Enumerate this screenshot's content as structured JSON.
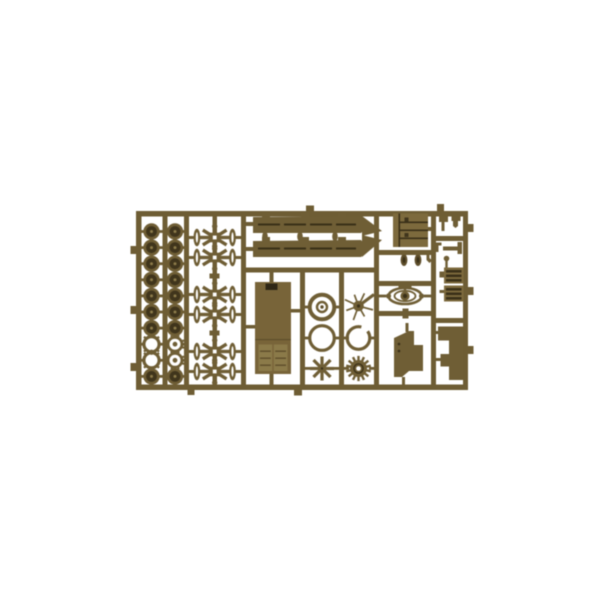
{
  "image": {
    "kind": "product photo",
    "description": "Olive-drab injection-molded plastic sprue (parts tree) of a small-scale tank model kit photographed on a plain white background",
    "background": "#ffffff"
  },
  "colors": {
    "rail": "#6e5d34",
    "plastic": "#6f5e35",
    "deck": "#7d6a3d",
    "super": "#786439",
    "pdark": "#40351c",
    "pdeep": "#3a3018",
    "pdeep2": "#2f2716",
    "pmid": "#5e4e2b",
    "plight": "#8b7a49"
  },
  "sprue": {
    "wheel_columns": [
      {
        "pattern": [
          "solid",
          "solid",
          "solid",
          "solid",
          "solid",
          "solid",
          "solid",
          "open",
          "open",
          "solid"
        ]
      },
      {
        "pattern": [
          "solid",
          "solid",
          "solid",
          "solid",
          "solid",
          "solid",
          "solid",
          "toothed",
          "toothed",
          "solid"
        ]
      }
    ],
    "bogie_count": 6,
    "star_wheel_spokes": 8,
    "sprocket_teeth": 14,
    "spider_legs": 7,
    "inventory": [
      {
        "part": "road wheel (solid)",
        "count": 16
      },
      {
        "part": "road wheel (open ring)",
        "count": 2
      },
      {
        "part": "road wheel (toothed ring)",
        "count": 2
      },
      {
        "part": "suspension bogie assembly",
        "count": 6
      },
      {
        "part": "track fender / hull side",
        "count": 2
      },
      {
        "part": "fender end tip",
        "count": 2
      },
      {
        "part": "connector pill",
        "count": 3
      },
      {
        "part": "engine deck plate",
        "count": 1
      },
      {
        "part": "periscope pod",
        "count": 2
      },
      {
        "part": "superstructure roof with hatches",
        "count": 1
      },
      {
        "part": "drive sprocket ring",
        "count": 1
      },
      {
        "part": "plain ring wheel",
        "count": 1
      },
      {
        "part": "notched ring wheel",
        "count": 1
      },
      {
        "part": "spoked idler star",
        "count": 1
      },
      {
        "part": "toothed sprocket disc",
        "count": 1
      },
      {
        "part": "spoked small part",
        "count": 1
      },
      {
        "part": "mount cupola top view",
        "count": 1
      },
      {
        "part": "glacis hull plate",
        "count": 1
      },
      {
        "part": "engine grille block",
        "count": 2
      },
      {
        "part": "small clip",
        "count": 2
      },
      {
        "part": "lever and pins",
        "count": 3
      },
      {
        "part": "stepped rear plate",
        "count": 1
      }
    ]
  }
}
